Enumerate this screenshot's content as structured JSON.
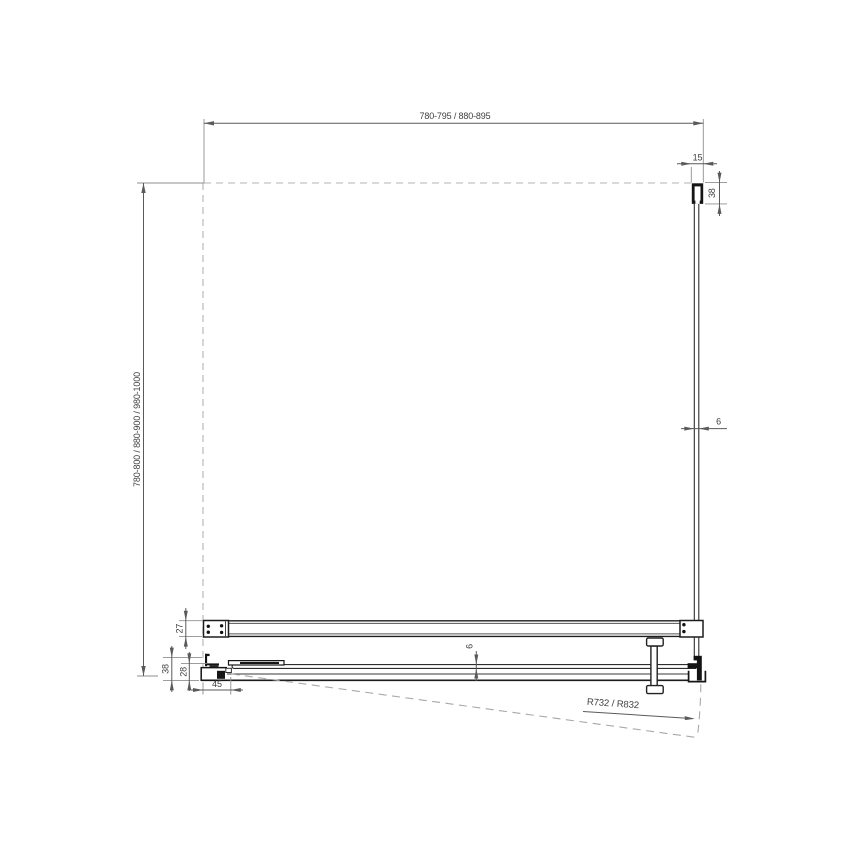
{
  "drawing": {
    "type": "technical-plan-view-shower-enclosure",
    "labels": {
      "overall_width": "780-795 / 880-895",
      "overall_depth": "780-800 / 880-900 / 980-1000",
      "wall_profile_width": "15",
      "wall_profile_depth": "38",
      "side_glass_thickness": "6",
      "top_profile_depth": "27",
      "bottom_profile_depth": "38",
      "bottom_profile_inner_depth": "28",
      "hinge_offset": "45",
      "door_glass_thickness": "6",
      "door_swing_radius": "R732 / R832"
    },
    "colors": {
      "background": "#ffffff",
      "profile_outline": "#1a1a1a",
      "thin_line": "#3a3a3a",
      "dimension_line": "#5a5a5a",
      "extension_line": "#8f8f8f",
      "dashed_line": "#b3b3b3",
      "text": "#3f3f3f"
    }
  }
}
